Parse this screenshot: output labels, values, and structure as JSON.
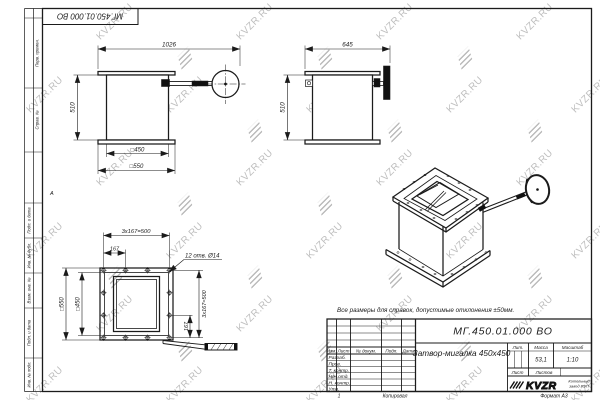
{
  "watermark": {
    "text": "KVZR.RU"
  },
  "top_stamp": {
    "doc_number": "МГ.450.01.000 ВО"
  },
  "left_margin": {
    "col_top": [
      "Перв. примен.",
      "Справ. №"
    ],
    "col_bottom": [
      "Подп. и дата",
      "Инв. № дубл.",
      "Взам. инв. №",
      "Подп. и дата",
      "Инв. № подл."
    ]
  },
  "zones": {
    "row_letter": "А",
    "col_number": "1"
  },
  "note": "Все размеры для справок, допустимые отклонения ±50мм.",
  "views": {
    "front": {
      "width": "1026",
      "height": "510",
      "inner_square": "□450",
      "outer_square": "□550"
    },
    "side": {
      "width": "645",
      "height": "510"
    },
    "plan": {
      "pitch_top": "3х167=500",
      "offset_top": "167",
      "holes_note": "12 отв. Ø14",
      "outer_square": "□550",
      "inner_square": "□450",
      "pitch_right": "3х167=500",
      "offset_right": "167"
    }
  },
  "title_block": {
    "doc_number": "МГ.450.01.000 ВО",
    "name": "Затвор-мигалка 450х450",
    "mass_value": "53,1",
    "scale_value": "1:10",
    "headers": {
      "lit": "Лит.",
      "mass": "Масса",
      "scale": "Масштаб",
      "sheet": "Лист",
      "sheets": "Листов"
    },
    "cols": {
      "izm": "Изм.",
      "list": "Лист",
      "doc": "№ докум.",
      "podp": "Подп.",
      "data": "Дата"
    },
    "rows": {
      "r1": "Разраб.",
      "r2": "Пров.",
      "r3": "Т. контр.",
      "r4": "Нач.отд.",
      "r5": "Н. контр.",
      "r6": "Утв."
    },
    "company": {
      "logo": "KVZR",
      "line1": "Котельный",
      "line2": "завод РЭП"
    },
    "footer": {
      "copied": "Копировал",
      "format": "Формат А3"
    }
  }
}
